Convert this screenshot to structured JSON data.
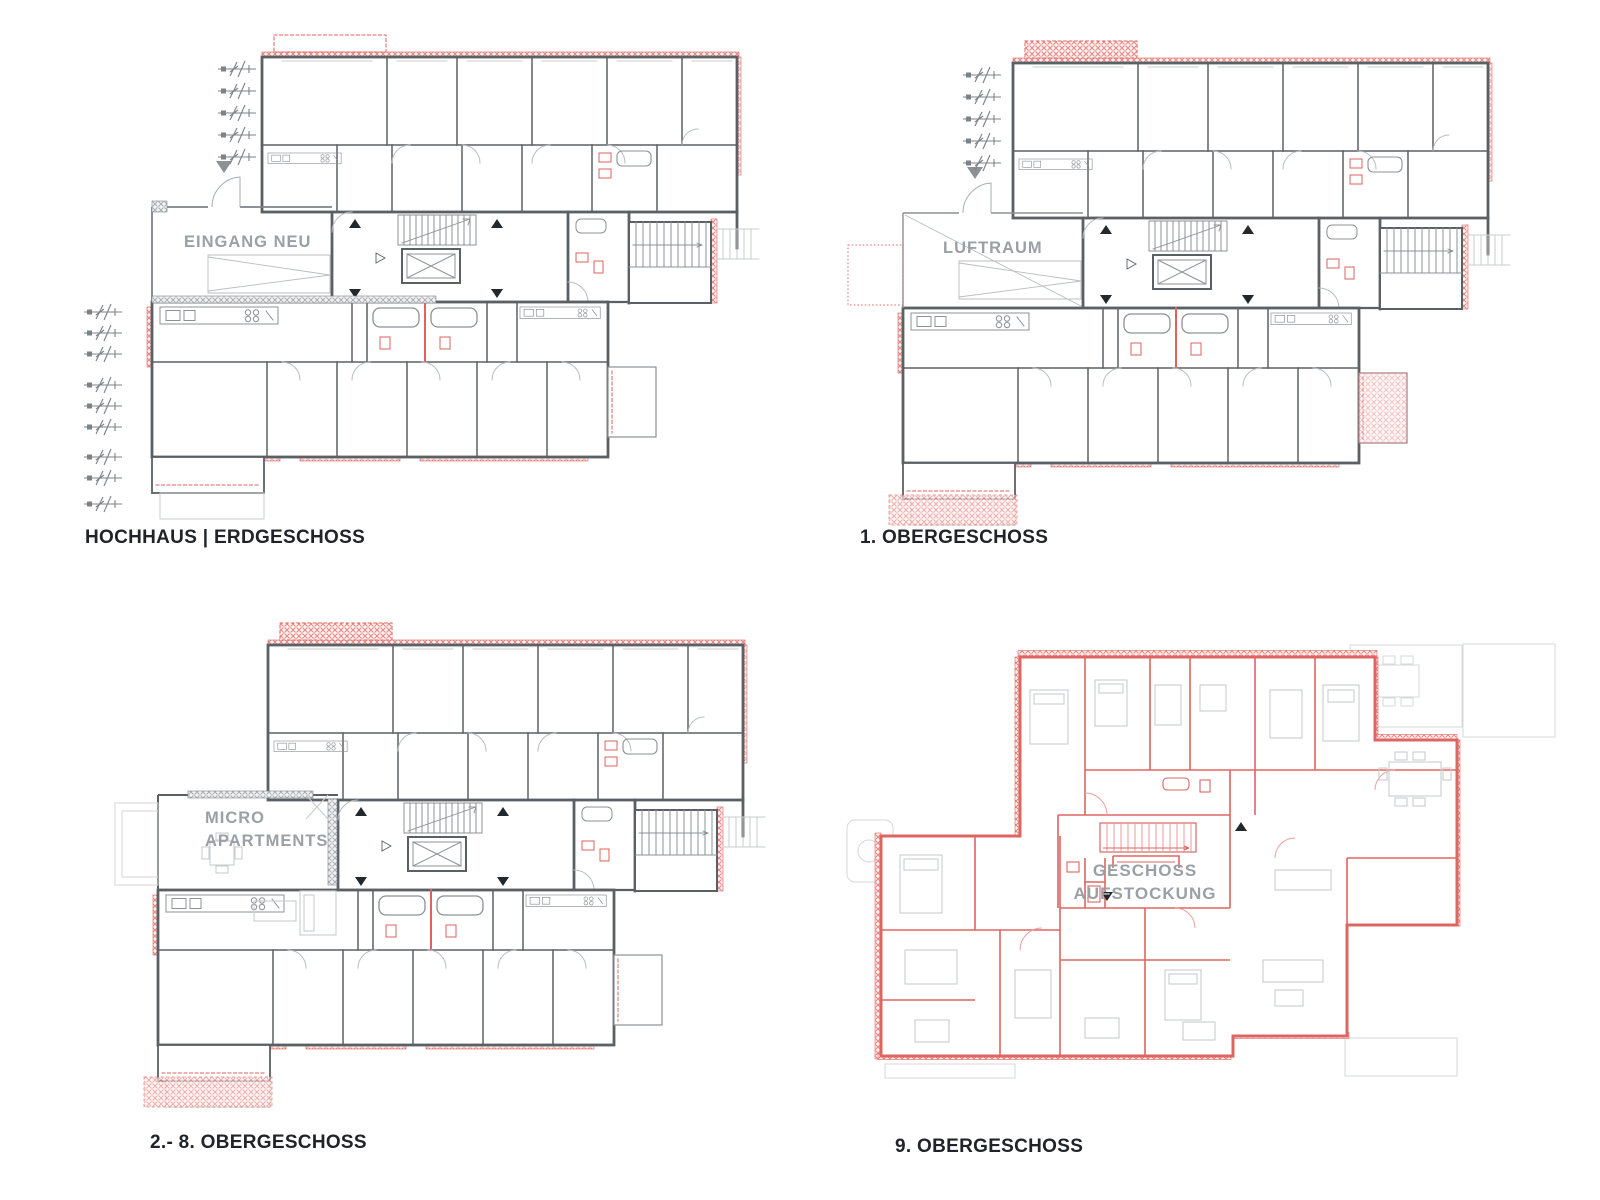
{
  "sheet": {
    "type": "architectural-floor-plans",
    "background": "#ffffff"
  },
  "colors": {
    "accent_red": "#df625e",
    "wall_dark_gray": "#5b6065",
    "medium_gray": "#8c9196",
    "furniture_light_gray": "#c9ccce",
    "annotation_gray": "#9aa0a5",
    "title_color": "#202428"
  },
  "plans": [
    {
      "id": "erdgeschoss",
      "title": "HOCHHAUS | ERDGESCHOSS",
      "labels": [
        "EINGANG NEU"
      ]
    },
    {
      "id": "og1",
      "title": "1. OBERGESCHOSS",
      "labels": [
        "LUFTRAUM"
      ]
    },
    {
      "id": "og2-8",
      "title": "2.- 8. OBERGESCHOSS",
      "labels": [
        "MICRO",
        "APARTMENTS"
      ]
    },
    {
      "id": "og9",
      "title": "9. OBERGESCHOSS",
      "labels": [
        "GESCHOSS",
        "AUFSTOCKUNG"
      ]
    }
  ]
}
